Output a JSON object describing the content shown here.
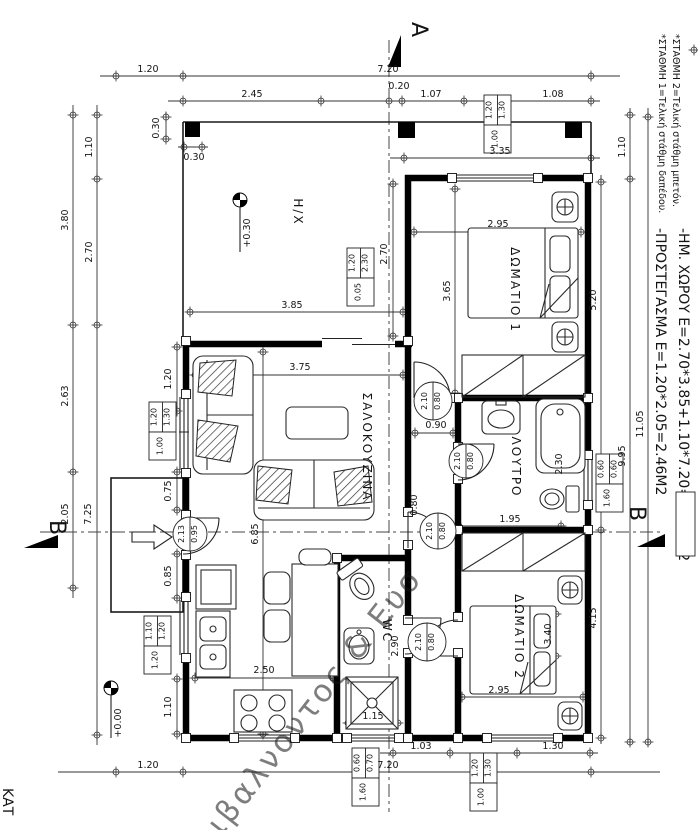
{
  "sheet": {
    "plan_label_partial": "ΚΑΤ",
    "watermark_text": "ιβαλνοντος & Ευσ",
    "watermark_color": "#7668c4"
  },
  "section_markers": [
    {
      "t": "A",
      "x": 412,
      "y": 22,
      "rot": 90,
      "size": 22
    },
    {
      "t": "B",
      "x": 50,
      "y": 520,
      "rot": 90,
      "size": 22
    },
    {
      "t": "B",
      "x": 630,
      "y": 506,
      "rot": 90,
      "size": 22
    }
  ],
  "level_labels": [
    {
      "t": "+0.30",
      "x": 250,
      "y": 233,
      "rot": -90,
      "size": 9.5
    },
    {
      "t": "+0.00",
      "x": 121,
      "y": 723,
      "rot": -90,
      "size": 9.5
    }
  ],
  "notes": [
    {
      "t": "*ΣΤΑΘΜΗ 1=Τελική στάθμη δαπέδου.",
      "x": 659,
      "y": 34,
      "rot": 90,
      "size": 9.5
    },
    {
      "t": "*ΣΤΑΘΜΗ 2=Τελική στάθμη μπετόν.",
      "x": 673,
      "y": 34,
      "rot": 90,
      "size": 9.5
    },
    {
      "t": "-ΠΡΟΣΤΕΓΑΣΜΑ Ε=1.20*2.05=2.46Μ2",
      "x": 656,
      "y": 228,
      "rot": 90,
      "size": 14
    },
    {
      "t": "-ΗΜ. ΧΩΡΟΥ Ε=2.70*3.85+1.10*7.20=18.32Μ2",
      "x": 679,
      "y": 228,
      "rot": 90,
      "size": 14
    },
    {
      "t": "ΚΑΤ",
      "x": 3,
      "y": 788,
      "rot": 90,
      "size": 14
    }
  ],
  "room_labels": [
    {
      "t": "Η/Χ",
      "x": 294,
      "y": 212
    },
    {
      "t": "ΔΩΜΑΤΙΟ 1",
      "x": 511,
      "y": 290
    },
    {
      "t": "ΣΑΛΟΚΟΥΖΙΝΑ",
      "x": 363,
      "y": 447
    },
    {
      "t": "ΛΟΥΤΡΟ",
      "x": 512,
      "y": 467
    },
    {
      "t": "WC",
      "x": 383,
      "y": 631
    },
    {
      "t": "ΔΩΜΑΤΙΟ 2",
      "x": 515,
      "y": 637
    }
  ],
  "dim_labels": [
    {
      "t": "1.20",
      "x": 148,
      "y": 72
    },
    {
      "t": "7.20",
      "x": 388,
      "y": 72
    },
    {
      "t": "2.45",
      "x": 252,
      "y": 97
    },
    {
      "t": "0.20",
      "x": 399,
      "y": 89
    },
    {
      "t": "1.07",
      "x": 431,
      "y": 97
    },
    {
      "t": "1.08",
      "x": 553,
      "y": 97
    },
    {
      "t": "0.30",
      "x": 159,
      "y": 128,
      "v": 1
    },
    {
      "t": "0.30",
      "x": 194,
      "y": 160
    },
    {
      "t": "3.35",
      "x": 500,
      "y": 154
    },
    {
      "t": "3.80",
      "x": 68,
      "y": 220,
      "v": 1
    },
    {
      "t": "1.10",
      "x": 92,
      "y": 147,
      "v": 1
    },
    {
      "t": "2.70",
      "x": 92,
      "y": 252,
      "v": 1
    },
    {
      "t": "2.63",
      "x": 68,
      "y": 396,
      "v": 1
    },
    {
      "t": "2.05",
      "x": 68,
      "y": 514,
      "v": 1
    },
    {
      "t": "7.25",
      "x": 91,
      "y": 514,
      "v": 1
    },
    {
      "t": "1.20",
      "x": 171,
      "y": 379,
      "v": 1
    },
    {
      "t": "0.75",
      "x": 171,
      "y": 491,
      "v": 1
    },
    {
      "t": "0.85",
      "x": 171,
      "y": 576,
      "v": 1
    },
    {
      "t": "1.10",
      "x": 171,
      "y": 707,
      "v": 1
    },
    {
      "t": "1.20",
      "x": 148,
      "y": 768
    },
    {
      "t": "7.20",
      "x": 388,
      "y": 768
    },
    {
      "t": "1.03",
      "x": 421,
      "y": 749
    },
    {
      "t": "1.30",
      "x": 553,
      "y": 749
    },
    {
      "t": "5.20",
      "x": 596,
      "y": 300,
      "v": 1
    },
    {
      "t": "4.15",
      "x": 596,
      "y": 618,
      "v": 1
    },
    {
      "t": "1.10",
      "x": 625,
      "y": 147,
      "v": 1
    },
    {
      "t": "9.95",
      "x": 625,
      "y": 456,
      "v": 1
    },
    {
      "t": "11.05",
      "x": 643,
      "y": 424,
      "v": 1
    },
    {
      "t": "2.95",
      "x": 498,
      "y": 227
    },
    {
      "t": "3.65",
      "x": 450,
      "y": 291,
      "v": 1
    },
    {
      "t": "3.85",
      "x": 292,
      "y": 308
    },
    {
      "t": "2.70",
      "x": 387,
      "y": 254,
      "v": 1
    },
    {
      "t": "3.75",
      "x": 300,
      "y": 370
    },
    {
      "t": "6.85",
      "x": 258,
      "y": 534,
      "v": 1
    },
    {
      "t": "2.50",
      "x": 264,
      "y": 673
    },
    {
      "t": "1.15",
      "x": 373,
      "y": 719
    },
    {
      "t": "0.90",
      "x": 436,
      "y": 428
    },
    {
      "t": "1.95",
      "x": 510,
      "y": 522
    },
    {
      "t": "2.30",
      "x": 562,
      "y": 464,
      "v": 1
    },
    {
      "t": "0.80",
      "x": 417,
      "y": 505,
      "v": 1
    },
    {
      "t": "2.90",
      "x": 398,
      "y": 646,
      "v": 1
    },
    {
      "t": "2.95",
      "x": 499,
      "y": 693
    },
    {
      "t": "3.40",
      "x": 551,
      "y": 634,
      "v": 1
    }
  ],
  "window_tags": [
    {
      "x": 484,
      "y": 95,
      "a": "1.20",
      "b": "1.30",
      "s": "1.00"
    },
    {
      "x": 347,
      "y": 248,
      "a": "1.20",
      "b": "2.30",
      "s": "0.05"
    },
    {
      "x": 149,
      "y": 402,
      "a": "1.20",
      "b": "1.30",
      "s": "1.00"
    },
    {
      "x": 144,
      "y": 616,
      "a": "1.10",
      "b": "1.20",
      "s": "1.20"
    },
    {
      "x": 596,
      "y": 454,
      "a": "0.60",
      "b": "0.60",
      "s": "1.60"
    },
    {
      "x": 352,
      "y": 748,
      "a": "0.60",
      "b": "0.70",
      "s": "1.60"
    },
    {
      "x": 470,
      "y": 753,
      "a": "1.20",
      "b": "1.30",
      "s": "1.00"
    }
  ],
  "door_tags": [
    {
      "x": 190,
      "y": 534,
      "r": 17,
      "a": "2.13",
      "b": "0.95"
    },
    {
      "x": 433,
      "y": 401,
      "r": 19,
      "a": "2.10",
      "b": "0.80"
    },
    {
      "x": 466,
      "y": 461,
      "r": 17,
      "a": "2.10",
      "b": "0.80"
    },
    {
      "x": 438,
      "y": 531,
      "r": 18,
      "a": "2.10",
      "b": "0.80"
    },
    {
      "x": 427,
      "y": 642,
      "r": 19,
      "a": "2.10",
      "b": "0.80"
    }
  ]
}
